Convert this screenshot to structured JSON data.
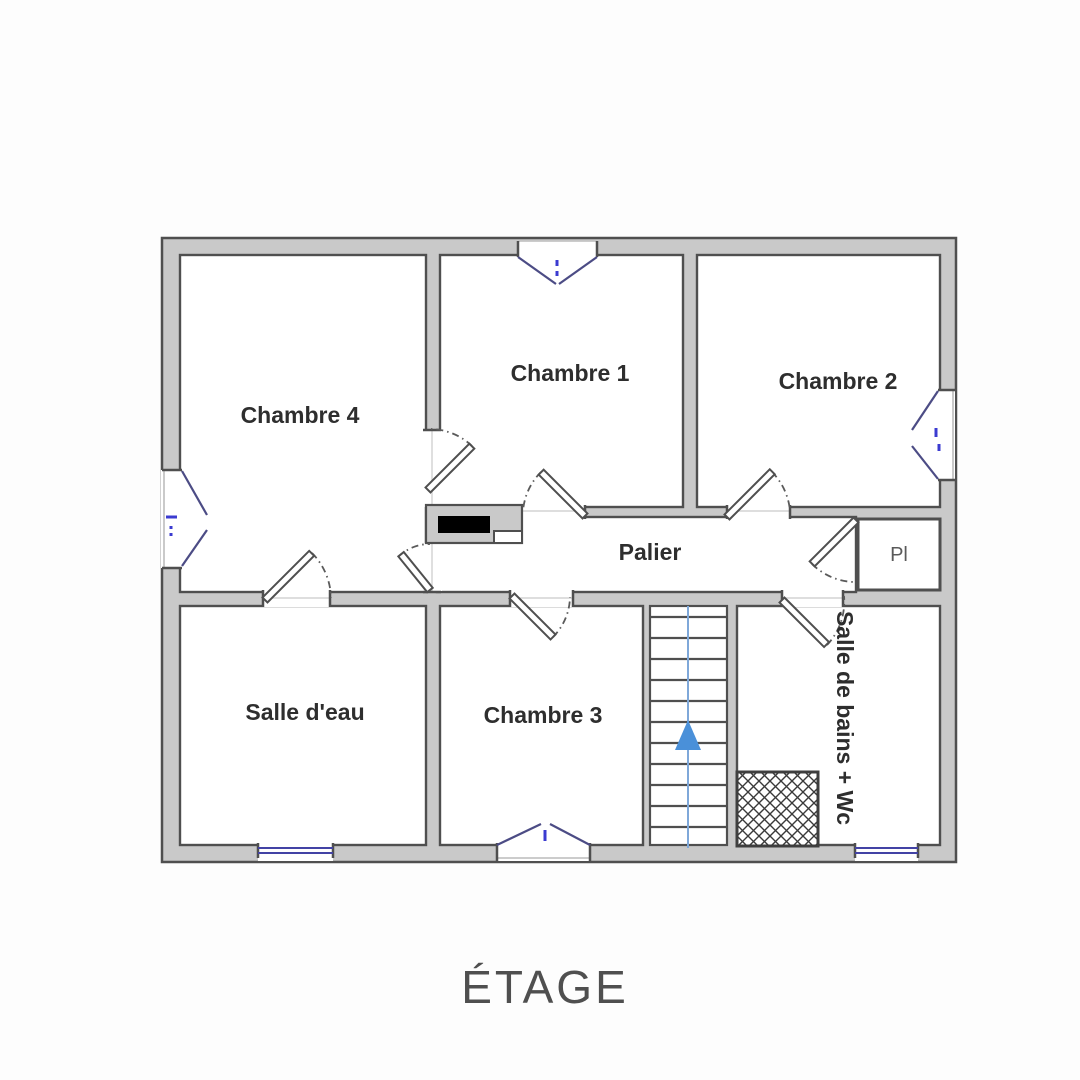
{
  "title": "ÉTAGE",
  "plan": {
    "rooms": [
      {
        "label": "Chambre 1"
      },
      {
        "label": "Chambre 2"
      },
      {
        "label": "Chambre 3"
      },
      {
        "label": "Chambre 4"
      },
      {
        "label": "Salle d'eau"
      },
      {
        "label": "Palier"
      },
      {
        "label": "Salle de bains + Wc"
      },
      {
        "label": "Pl"
      }
    ],
    "stairs": {
      "direction": "up",
      "treads": 12
    },
    "door_count": 8,
    "window_count": 6
  },
  "colors": {
    "wall_fill": "#c9c9c9",
    "wall_outline": "#4f4f4f",
    "window_blue": "#4343a5",
    "door_symbol": "#4c4c85",
    "stair_guide_blue": "#7fa8d9",
    "stair_arrow_blue": "#4a90d9",
    "duct_black": "#000000",
    "title_gray": "#4f4f4f"
  }
}
